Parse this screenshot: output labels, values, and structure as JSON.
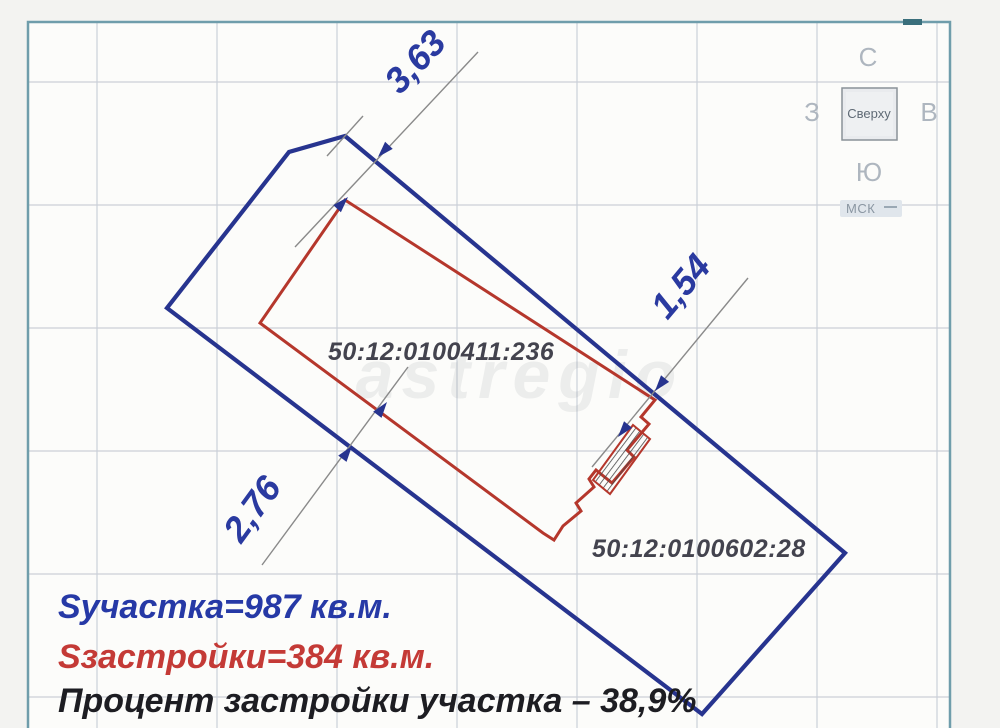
{
  "compass": {
    "north": "С",
    "west": "З",
    "east": "В",
    "south": "Ю",
    "view_button_label": "Сверху",
    "crs_label": "МСК"
  },
  "dimensions": [
    {
      "label": "3,63"
    },
    {
      "label": "1,54"
    },
    {
      "label": "2,76"
    }
  ],
  "parcels": [
    {
      "cadastral_number": "50:12:0100411:236"
    },
    {
      "cadastral_number": "50:12:0100602:28"
    }
  ],
  "summary": {
    "plot_area": "Sучастка=987 кв.м.",
    "building_area": "Sзастройки=384 кв.м.",
    "coverage_percent": "Процент застройки участка – 38,9%"
  },
  "watermark": "astregio",
  "colors": {
    "parcel_boundary": "#27348f",
    "building_outline": "#b5372c",
    "dimension_line": "#8a8a8a",
    "dimension_text": "#2a3aa0",
    "plot_area_text": "#2639a6",
    "building_area_text": "#c43a36",
    "coverage_text": "#1d1d22",
    "cadastral_text": "#43434e",
    "border": "#6f9dab",
    "grid": "#cbd0d8"
  }
}
